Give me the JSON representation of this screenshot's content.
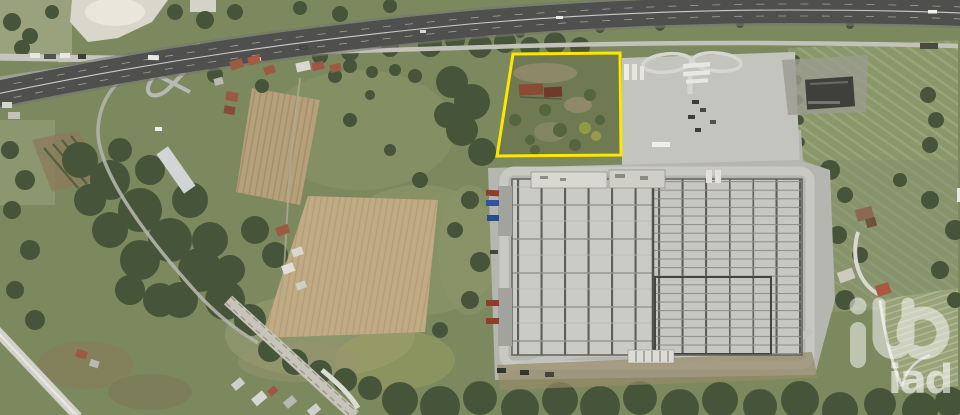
{
  "image": {
    "kind": "aerial-satellite-photo",
    "subject": "rural land parcel highlighted beside industrial warehouse and motorway"
  },
  "watermark": {
    "brand": "iad",
    "color": "#ffffff",
    "mark_opacity": "0.5",
    "text_opacity": "0.6"
  },
  "parcel": {
    "name": "highlighted-parcel",
    "outline_color": "#FFE600",
    "stroke_width": "3",
    "points": "513,54 620,53 621,155 497,156"
  },
  "colors": {
    "vegetation_base": "#7c895f",
    "woodland": "#46553a",
    "plowed_field": "#b5a07c",
    "highway_asphalt": "#4f4f4d",
    "road_light": "#c2c2bb",
    "railway": "#c7c4b9",
    "warehouse_roof": "#c9c9c3",
    "apron_concrete": "#b6b6b1",
    "truckstop_concrete": "#c4c4bf",
    "quarry_white": "#d9d6cb",
    "red_roof": "#9c5a42",
    "trailer_red": "#8f3c2d",
    "trailer_blue": "#32539b"
  },
  "scene": {
    "features": [
      "motorway",
      "motorway-interchange",
      "service-road",
      "quarry",
      "orchard",
      "woodland",
      "plowed-fields",
      "meadows",
      "rural-houses",
      "greenhouse",
      "railway-line",
      "truck-parking-area",
      "derelict-shed",
      "industrial-warehouse",
      "loading-docks",
      "warehouse-apron",
      "highlighted-parcel",
      "parcel-building",
      "watermark-logo"
    ]
  }
}
